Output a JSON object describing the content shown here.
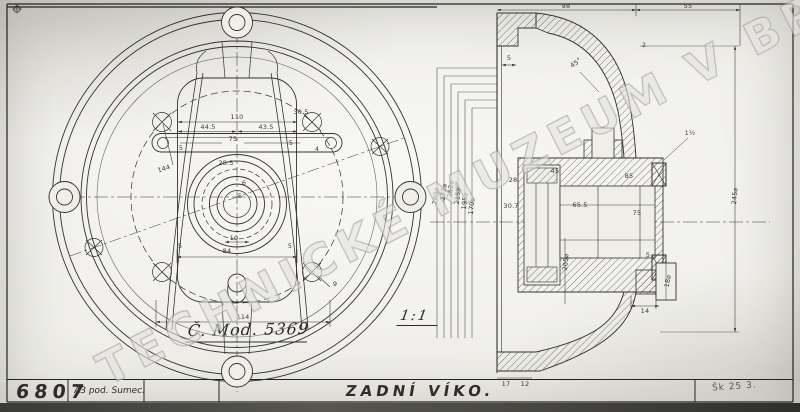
{
  "title_block": {
    "drawing_number": "6807",
    "format_note": "A3 pod. Sumec.",
    "title": "ZADNÍ VÍKO.",
    "sheet_note": "Šk 25 3."
  },
  "watermark": {
    "text": "TECHNICKÉ MUZEUM V BRNĚ"
  },
  "front_view": {
    "model_note": "Č. Mod. 5369",
    "dimensions": [
      {
        "t": "110",
        "x": 237,
        "y": 117
      },
      {
        "t": "44.5",
        "x": 208,
        "y": 127
      },
      {
        "t": "43.5",
        "x": 266,
        "y": 127
      },
      {
        "t": "75",
        "x": 233,
        "y": 139
      },
      {
        "t": "5",
        "x": 181,
        "y": 148
      },
      {
        "t": "5",
        "x": 291,
        "y": 143
      },
      {
        "t": "4",
        "x": 317,
        "y": 149
      },
      {
        "t": "28.5",
        "x": 226,
        "y": 163
      },
      {
        "t": "144",
        "x": 164,
        "y": 169,
        "r": -18
      },
      {
        "t": "30.5",
        "x": 301,
        "y": 112
      },
      {
        "t": "6",
        "x": 244,
        "y": 183
      },
      {
        "t": "5",
        "x": 240,
        "y": 196
      },
      {
        "t": "10",
        "x": 234,
        "y": 238
      },
      {
        "t": "84",
        "x": 227,
        "y": 251
      },
      {
        "t": "5",
        "x": 180,
        "y": 246
      },
      {
        "t": "5",
        "x": 290,
        "y": 246
      },
      {
        "t": "9",
        "x": 335,
        "y": 284
      },
      {
        "t": "114",
        "x": 243,
        "y": 317
      }
    ]
  },
  "section_view": {
    "scale_note": "1:1",
    "dimensions": [
      {
        "t": "98",
        "x": 566,
        "y": 6
      },
      {
        "t": "55",
        "x": 688,
        "y": 6
      },
      {
        "t": "5",
        "x": 509,
        "y": 58
      },
      {
        "t": "45°",
        "x": 576,
        "y": 63,
        "r": -38
      },
      {
        "t": "2",
        "x": 644,
        "y": 45
      },
      {
        "t": "280⌀",
        "x": 436,
        "y": 196,
        "r": -83
      },
      {
        "t": "272⌀",
        "x": 444,
        "y": 192,
        "r": -83
      },
      {
        "t": "252⌀",
        "x": 451,
        "y": 189,
        "r": -83
      },
      {
        "t": "215⌀",
        "x": 458,
        "y": 196,
        "r": -83
      },
      {
        "t": "195⌀",
        "x": 465,
        "y": 201,
        "r": -83
      },
      {
        "t": "170⌀",
        "x": 472,
        "y": 206,
        "r": -83
      },
      {
        "t": "245⌀",
        "x": 735,
        "y": 196,
        "r": -85
      },
      {
        "t": "205⌀",
        "x": 566,
        "y": 262,
        "r": -85
      },
      {
        "t": "1½",
        "x": 690,
        "y": 133
      },
      {
        "t": "28",
        "x": 513,
        "y": 180
      },
      {
        "t": "30.7",
        "x": 511,
        "y": 206
      },
      {
        "t": "45",
        "x": 555,
        "y": 171
      },
      {
        "t": "85",
        "x": 629,
        "y": 176
      },
      {
        "t": "65.5",
        "x": 580,
        "y": 205
      },
      {
        "t": "75",
        "x": 637,
        "y": 213
      },
      {
        "t": "5",
        "x": 648,
        "y": 255
      },
      {
        "t": "14",
        "x": 645,
        "y": 311
      },
      {
        "t": "18⌀",
        "x": 668,
        "y": 281,
        "r": -80
      },
      {
        "t": "17",
        "x": 506,
        "y": 384
      },
      {
        "t": "12",
        "x": 525,
        "y": 384
      }
    ]
  },
  "colors": {
    "ink": "#33322e",
    "paper": "#efeee9",
    "watermark_gray": "#b9b8b2",
    "scan_edge": "#3a3a38"
  }
}
